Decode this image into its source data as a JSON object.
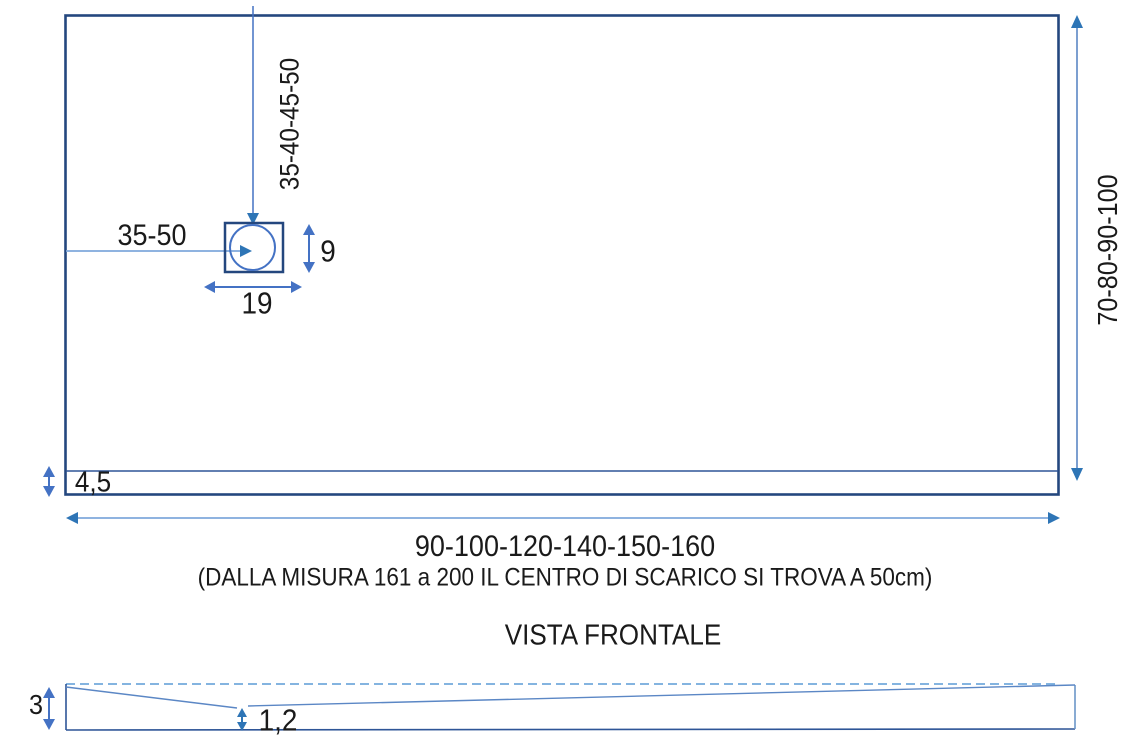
{
  "diagram": {
    "top_view": {
      "drain_offset_vertical_label": "35-40-45-50",
      "drain_offset_horizontal_label": "35-50",
      "drain_height_label": "9",
      "drain_width_label": "19",
      "depth_range_label": "70-80-90-100",
      "border_thickness_label": "4,5",
      "width_range_label": "90-100-120-140-150-160",
      "width_note": "(DALLA MISURA 161 a 200 IL CENTRO DI SCARICO SI TROVA A 50cm)"
    },
    "front_view": {
      "title": "VISTA FRONTALE",
      "edge_height_label": "3",
      "min_thickness_label": "1,2"
    },
    "colors": {
      "outline_navy": "#24477E",
      "thin_navy": "#2E5597",
      "line_blue": "#5B87C5",
      "light_blue": "#7FA8DC",
      "arrow_blue": "#2E75B6",
      "dim_blue": "#4472C4",
      "text": "#1A1A1A"
    }
  }
}
